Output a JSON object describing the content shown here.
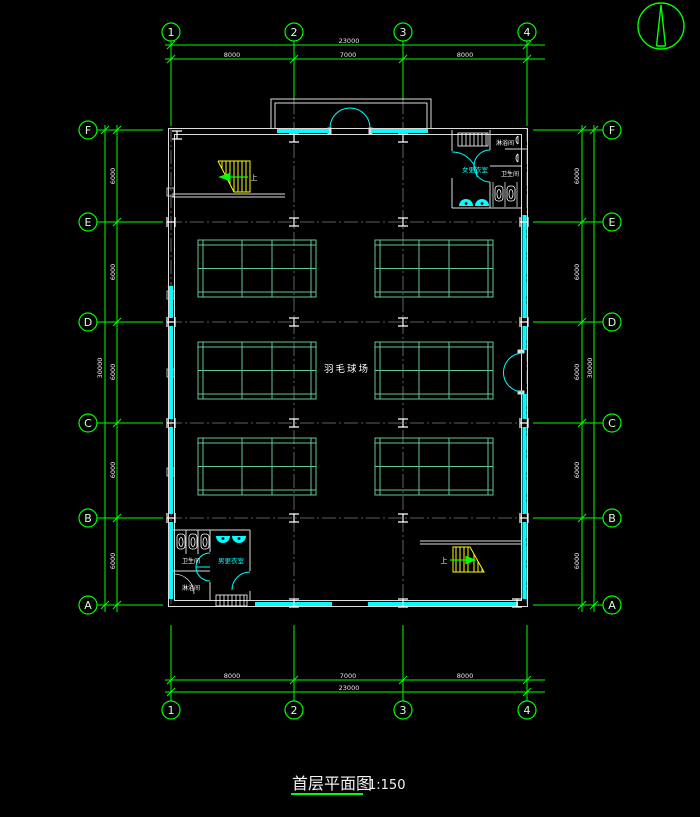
{
  "drawing_title": {
    "text": "首层平面图",
    "scale": "1:150"
  },
  "grid": {
    "cols": [
      "1",
      "2",
      "3",
      "4"
    ],
    "rows": [
      "F",
      "E",
      "D",
      "C",
      "B",
      "A"
    ]
  },
  "dims": {
    "top": {
      "total": "23000",
      "segments": [
        "8000",
        "7000",
        "8000"
      ]
    },
    "bottom": {
      "total": "23000",
      "segments": [
        "8000",
        "7000",
        "8000"
      ]
    },
    "left": {
      "total": "30000",
      "segments": [
        "6000",
        "6000",
        "6000",
        "6000",
        "6000"
      ]
    },
    "right": {
      "total": "30000",
      "segments": [
        "6000",
        "6000",
        "6000",
        "6000",
        "6000"
      ]
    }
  },
  "labels": {
    "court": "羽毛球场",
    "women_changing": "女更衣室",
    "men_changing": "男更衣室",
    "toilet": "卫生间",
    "shower": "淋浴间",
    "stair_up": "上"
  },
  "colors": {
    "grid_green": "#00ff00",
    "curtain_cyan": "#00ffff",
    "stair_yellow": "#ffff00",
    "court_teal": "#63c898",
    "wall_white": "#dcdcdc",
    "centerline_gray": "#7d7d7d",
    "background": "#000000"
  }
}
